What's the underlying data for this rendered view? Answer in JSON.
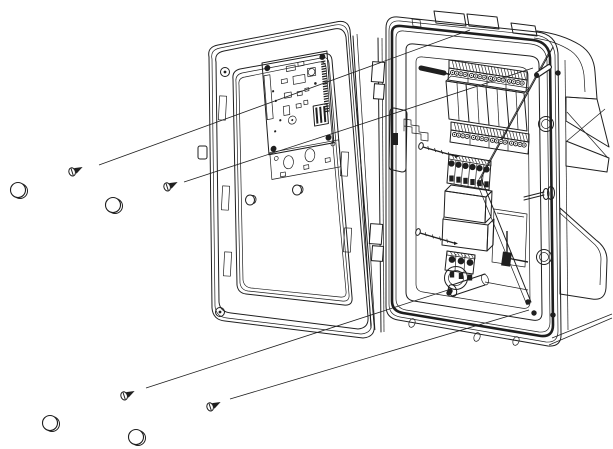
{
  "meta": {
    "title": "Controller enclosure exploded mounting diagram",
    "type": "technical-line-drawing",
    "visible_text": "none"
  },
  "canvas": {
    "width": 613,
    "height": 449,
    "background": "#ffffff",
    "ink": "#1f1f1f"
  },
  "assemblies": {
    "door": {
      "label": "hinged door, open to the left",
      "pcb": {
        "label": "controller circuit board",
        "corner_screws": 4,
        "edge_connector": true,
        "mounting_bracket_holes": 2
      },
      "door_hole_plugs": 2,
      "frame_slots": 5,
      "corner_details": 2
    },
    "hinge": {
      "label": "hinge column between door and body",
      "knuckles": 4
    },
    "body": {
      "label": "enclosure body",
      "top_terminal_strip": {
        "blocks": 4,
        "screws_per_block": 4
      },
      "relay_modules": 4,
      "middle_terminal_strip": {
        "blocks": 4,
        "screws_per_block": 4
      },
      "aux_terminal_block": {
        "positions": 6
      },
      "transformer_sections": 2,
      "power_terminal_block": {
        "positions": 3
      },
      "conduit_knockout": 1,
      "conduit_stub": 1,
      "wall_bosses": 2,
      "top_knockout_covers": 3,
      "bottom_rim_tabs": 3
    }
  },
  "fasteners": {
    "mounting_screws": [
      {
        "x": 75,
        "y": 171
      },
      {
        "x": 170,
        "y": 186
      },
      {
        "x": 127,
        "y": 395
      },
      {
        "x": 213,
        "y": 406
      }
    ],
    "hole_plugs": [
      {
        "x": 18,
        "y": 190
      },
      {
        "x": 113,
        "y": 205
      },
      {
        "x": 50,
        "y": 423
      },
      {
        "x": 136,
        "y": 437
      }
    ],
    "door_plugs": [
      {
        "x": 250,
        "y": 200
      },
      {
        "x": 297,
        "y": 190
      }
    ],
    "panel_pins": [
      {
        "x1": 421,
        "y1": 68,
        "x2": 444,
        "y2": 73,
        "style": "dark"
      },
      {
        "x1": 537,
        "y1": 75,
        "x2": 549,
        "y2": 67,
        "style": "outline"
      }
    ],
    "long_screws": [
      {
        "x1": 421,
        "y1": 146,
        "x2": 455,
        "y2": 156
      },
      {
        "x1": 418,
        "y1": 232,
        "x2": 454,
        "y2": 243
      }
    ],
    "rim_screws": [
      {
        "x": 558,
        "y": 73
      },
      {
        "x": 450,
        "y": 291
      },
      {
        "x": 528,
        "y": 302
      },
      {
        "x": 534,
        "y": 313
      },
      {
        "x": 553,
        "y": 315
      },
      {
        "x": 449,
        "y": 293
      }
    ]
  },
  "leader_lines": [
    {
      "x1": 99,
      "y1": 165,
      "x2": 470,
      "y2": 30
    },
    {
      "x1": 184,
      "y1": 182,
      "x2": 533,
      "y2": 68
    },
    {
      "x1": 146,
      "y1": 388,
      "x2": 448,
      "y2": 290
    },
    {
      "x1": 230,
      "y1": 399,
      "x2": 529,
      "y2": 310
    }
  ],
  "terminal_screw_layout": {
    "top_strip": {
      "count": 16,
      "x0": 452.5,
      "y0": 72.5,
      "dx": 4.2,
      "group_gap": 2.2,
      "group": 4,
      "slope": 0.152,
      "r": 2.1,
      "dark": false
    },
    "middle_strip": {
      "count": 16,
      "x0": 454.5,
      "y0": 134.5,
      "dx": 4.2,
      "group_gap": 2.2,
      "group": 4,
      "slope": 0.152,
      "r": 2.1,
      "dark": false
    },
    "aux_block": {
      "count": 6,
      "x0": 451.5,
      "y0": 163.5,
      "dx": 7.0,
      "group_gap": 0,
      "group": 6,
      "slope": 0.167,
      "r": 2.7,
      "dark": true
    },
    "power_block": {
      "count": 3,
      "x0": 452.0,
      "y0": 259.5,
      "dx": 9.0,
      "group_gap": 0,
      "group": 3,
      "slope": 0.167,
      "r": 2.9,
      "dark": true
    }
  }
}
